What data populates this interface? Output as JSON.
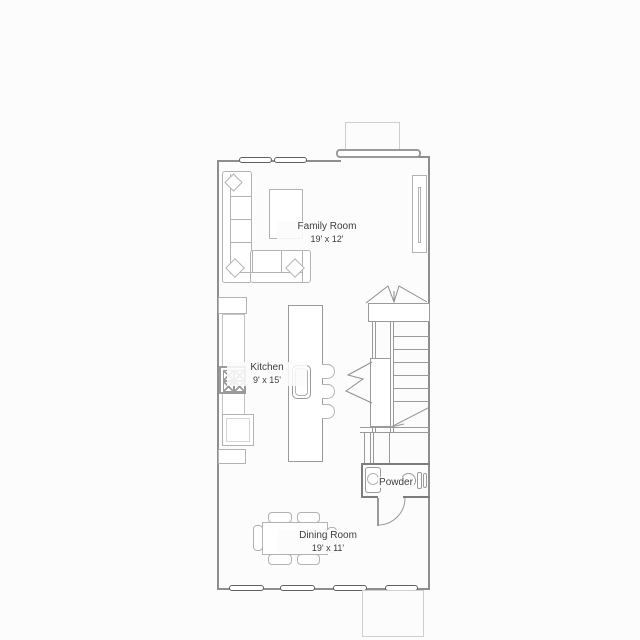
{
  "plan": {
    "type": "residential-floor-plan",
    "rooms": [
      {
        "name": "Family Room",
        "dims": "19' x 12'"
      },
      {
        "name": "Kitchen",
        "dims": "9' x 15'"
      },
      {
        "name": "Powder",
        "dims": ""
      },
      {
        "name": "Dining Room",
        "dims": "19' x 11'"
      }
    ],
    "fixtures": [
      "sectional-sofa",
      "throw-pillows",
      "coffee-table",
      "fireplace-chimney",
      "refrigerator",
      "kitchen-counter",
      "range-stove",
      "base-cabinet",
      "kitchen-island",
      "island-sink",
      "bar-stools",
      "staircase",
      "stair-landing",
      "stair-railing",
      "break-lines",
      "vanity-sink",
      "toilet",
      "interior-door",
      "dining-table",
      "dining-chairs",
      "windows",
      "porch-stoop"
    ],
    "window_count": {
      "top_wall": 2,
      "right_wall": 1,
      "bottom_wall": 4
    },
    "colors": {
      "background": "#fcfcfc",
      "wall": "#8e8e8e",
      "interior_line": "#9a9a9a",
      "furniture": "#b3b3b3",
      "window": "#606060",
      "light_outline": "#cfcfcf",
      "text": "#3d3d3d"
    }
  }
}
